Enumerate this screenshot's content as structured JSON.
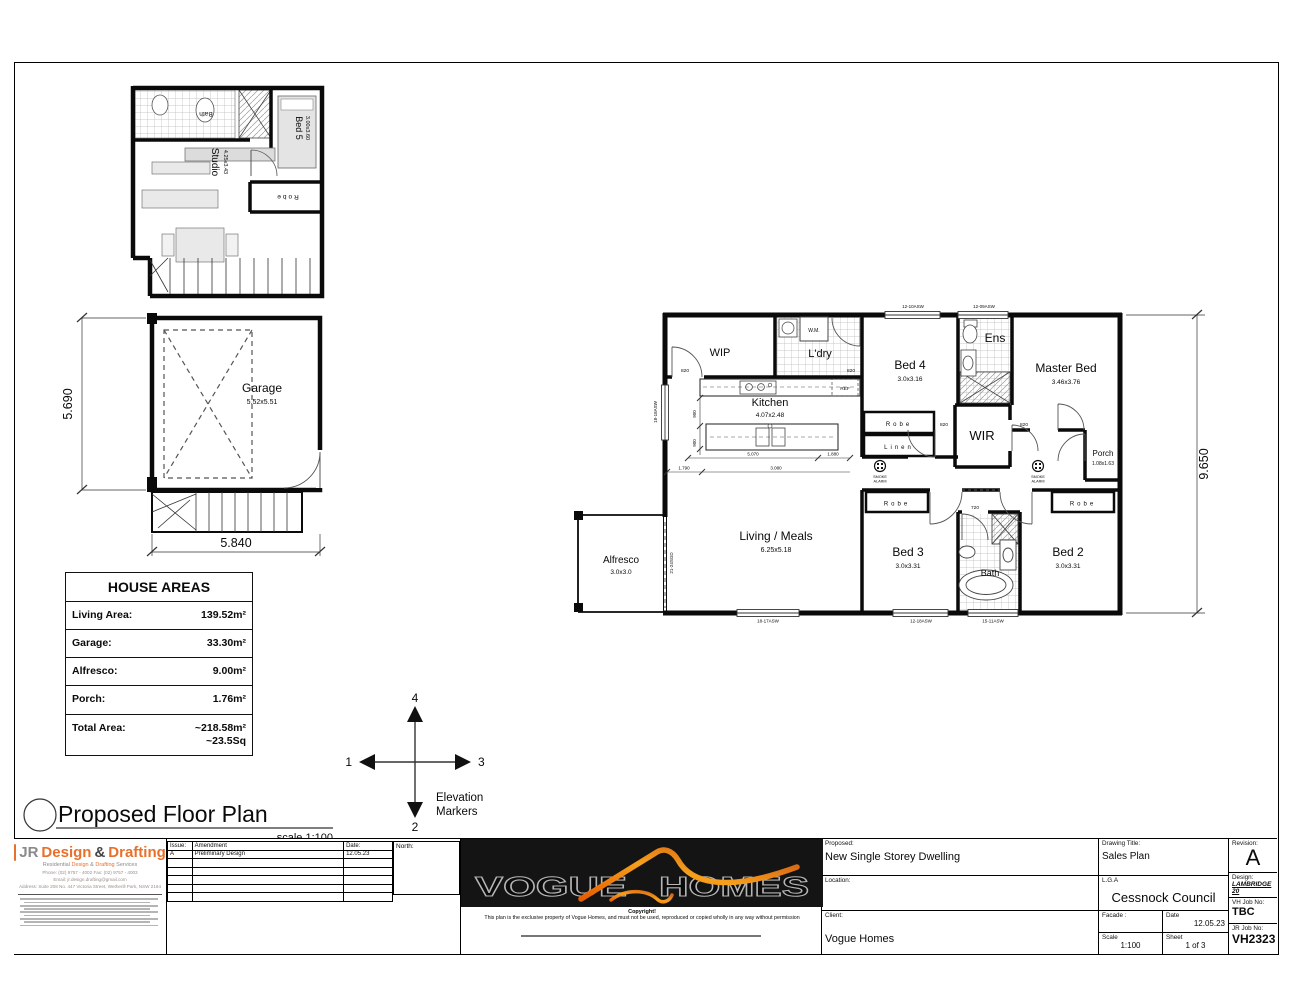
{
  "page": {
    "title": "Proposed Floor Plan",
    "scale": "scale 1:100"
  },
  "upper_plan": {
    "bath": "Bath",
    "bed5": "Bed 5",
    "bed5_size": "3.00x3.60",
    "studio": "Studio",
    "studio_size": "4.25x3.43",
    "robe": "Robe"
  },
  "garage_plan": {
    "name": "Garage",
    "size": "5.52x5.51",
    "dim_left": "5.690",
    "dim_bottom": "5.840"
  },
  "house_areas": {
    "title": "HOUSE AREAS",
    "rows": [
      {
        "label": "Living Area:",
        "value": "139.52m²"
      },
      {
        "label": "Garage:",
        "value": "33.30m²"
      },
      {
        "label": "Alfresco:",
        "value": "9.00m²"
      },
      {
        "label": "Porch:",
        "value": "1.76m²"
      },
      {
        "label": "Total Area:",
        "value": "~218.58m²",
        "value2": "~23.5Sq"
      }
    ]
  },
  "main_plan": {
    "rooms": {
      "wip": "WIP",
      "ldry": "L'dry",
      "wm": "W.M.",
      "ref": "REF",
      "kitchen": "Kitchen",
      "kitchen_size": "4.07x2.48",
      "bed4": "Bed 4",
      "bed4_size": "3.0x3.16",
      "ens": "Ens",
      "master": "Master Bed",
      "master_size": "3.46x3.76",
      "robe": "Robe",
      "linen": "Linen",
      "wir": "WIR",
      "porch": "Porch",
      "porch_size": "1.08x1.63",
      "living": "Living / Meals",
      "living_size": "6.25x5.18",
      "alfresco": "Alfresco",
      "alfresco_size": "3.0x3.0",
      "bed3": "Bed 3",
      "bed3_size": "3.0x3.31",
      "bath": "Bath",
      "bed2": "Bed 2",
      "bed2_size": "3.0x3.31"
    },
    "door_label": "820",
    "door_label_small": "720",
    "windows": {
      "top1": "12-10ASW",
      "top2": "12-09ASW",
      "bottom1": "18-17ASW",
      "bottom2": "12-18ASW",
      "bottom3": "15-11ASW",
      "left": "18-18ASW",
      "alfresco_door": "21-24SGD"
    },
    "smoke": {
      "line1": "SMOKE",
      "line2": "ALARM"
    },
    "dims": {
      "right": "9.650",
      "k1": "5.070",
      "k2": "1.880",
      "k3": "1.790",
      "k4": "3.080",
      "v900": "900"
    }
  },
  "elevation_markers": {
    "n1": "1",
    "n2": "2",
    "n3": "3",
    "n4": "4",
    "cap1": "Elevation",
    "cap2": "Markers"
  },
  "title_block": {
    "jr": {
      "logo_jr": "JR",
      "logo_design": "Design",
      "logo_amp": "&",
      "logo_drafting": "Drafting",
      "tagline_pre": "Residential",
      "tagline_design": "Design",
      "tagline_amp": "&",
      "tagline_drafting": "Drafting",
      "tagline_post": "Services",
      "phone": "Phone: (02) 9757 - 4002  Fax: (02) 9757 - 4003",
      "email": "Email: jr.design.drafting@gmail.com",
      "address": "Address: Suite 208 No. 447 Victoria Street, Wetherill Park, NSW 2164"
    },
    "amendments": {
      "col_issue": "Issue:",
      "col_amendment": "Amendment",
      "col_date": "Date:",
      "row_issue": "A",
      "row_amendment": "Preliminary Design",
      "row_date": "12.05.23"
    },
    "north_label": "North:",
    "vogue": {
      "word1": "VOGUE",
      "word2": "HOMES",
      "copyright_title": "Copyright!",
      "copyright_body": "This plan is the exclusive property of Vogue Homes, and must not be used, reproduced or copied wholly in any way without permission"
    },
    "fields": {
      "proposed_label": "Proposed:",
      "proposed": "New Single Storey Dwelling",
      "location_label": "Location:",
      "client_label": "Client:",
      "client": "Vogue Homes",
      "drawing_title_label": "Drawing Title:",
      "drawing_title": "Sales Plan",
      "lga_label": "L.G.A",
      "lga": "Cessnock Council",
      "facade_label": "Facade :",
      "date_label": "Date",
      "date": "12.05.23",
      "scale_label": "Scale",
      "scale": "1:100",
      "sheet_label": "Sheet",
      "sheet": "1 of 3",
      "revision_label": "Revision:",
      "revision": "A",
      "design_label": "Design:",
      "design": "LAMBRIDGE 20",
      "vh_job_label": "VH Job No:",
      "vh_job": "TBC",
      "jr_job_label": "JR Job No:",
      "jr_job": "VH2323"
    }
  }
}
